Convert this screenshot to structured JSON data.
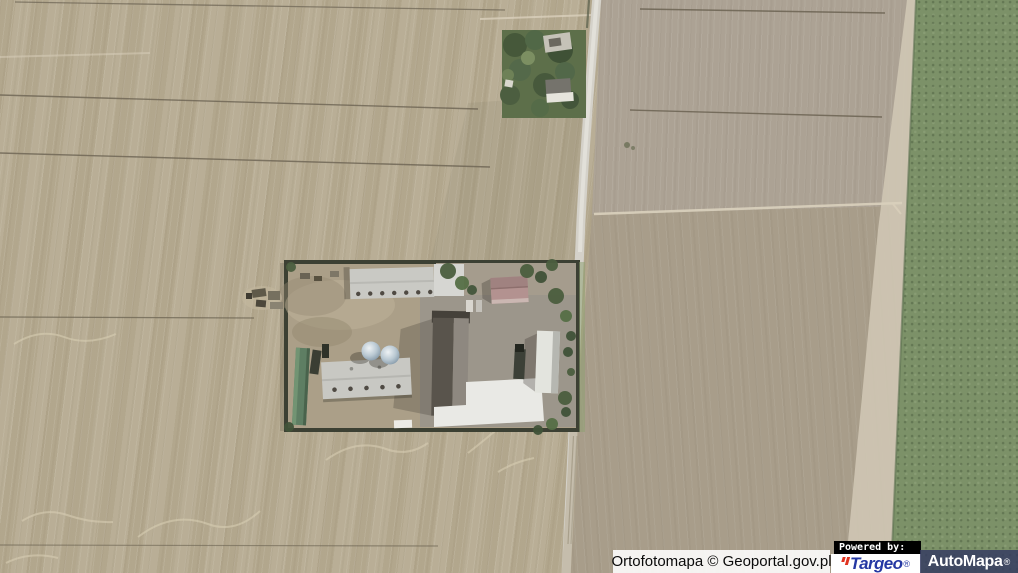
{
  "attribution": {
    "label": "Ortofotomapa © Geoportal.gov.pl"
  },
  "branding": {
    "powered_by_label": "Powered by:",
    "targeo": {
      "label": "Targeo",
      "registered_mark": "®",
      "brand_blue": "#2538a3",
      "brand_red": "#e03320"
    },
    "automapa": {
      "label": "AutoMapa",
      "registered_mark": "®",
      "text_color": "#ffffff",
      "panel_color": "#343c60"
    }
  },
  "map": {
    "imagery_colors": {
      "plowed_field_tan": "#b5aa90",
      "plowed_field_gray": "#aca294",
      "field_brown": "#a89d8a",
      "crop_field_green": "#7c9168",
      "road_gray": "#d4d1c9",
      "hedge_dark": "#3c4033"
    }
  }
}
